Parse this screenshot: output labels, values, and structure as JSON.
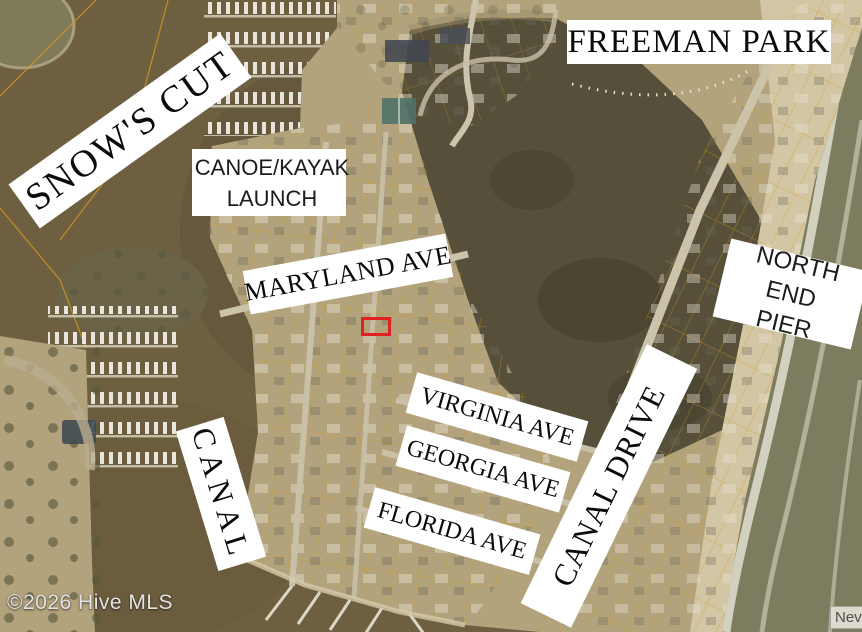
{
  "page": {
    "type": "aerial-parcel-map-photo",
    "description": "Satellite listing map with parcel overlay, street labels and highlighted subject lot"
  },
  "labels": {
    "snows_cut": "SNOW'S CUT",
    "freeman_park": "FREEMAN PARK",
    "canoe_kayak": {
      "line1": "CANOE/KAYAK",
      "line2": "LAUNCH"
    },
    "maryland_ave": "MARYLAND AVE",
    "north_end_pier": {
      "line1": "NORTH END",
      "line2": "PIER"
    },
    "virginia_ave": "VIRGINIA AVE",
    "georgia_ave": "GEORGIA AVE",
    "florida_ave": "FLORIDA AVE",
    "canal": "CANAL",
    "canal_drive": "CANAL DRIVE"
  },
  "watermarks": {
    "copyright": "©2026 Hive MLS",
    "corner_partial": "Nev"
  },
  "marker": {
    "subject_property": {
      "shape": "rectangle-outline",
      "color": "#e02121"
    }
  },
  "colors": {
    "water": "#6e5f41",
    "land": "#b2a37c",
    "marsh": "#56503a",
    "sand": "#d2c6a5",
    "ocean": "#7d7c5f",
    "parcel": "#d9991c",
    "subject": "#e02121"
  }
}
